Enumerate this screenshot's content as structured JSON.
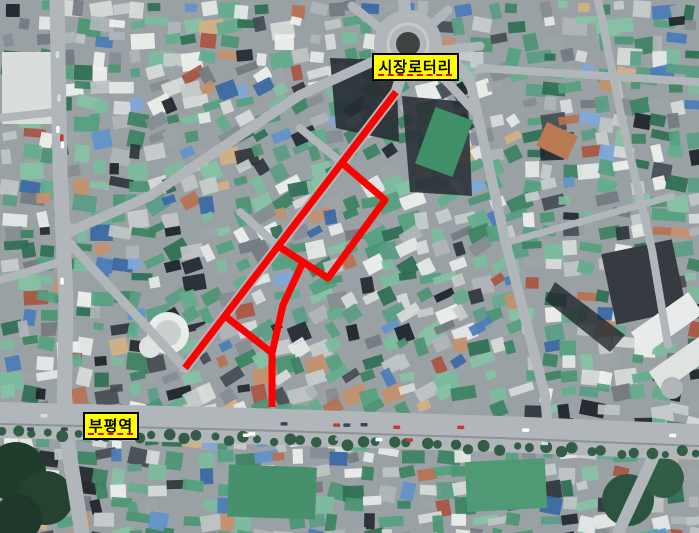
{
  "page": {
    "type": "aerial-map",
    "description": "부평역과 시장로터리 일대 항공사진 위에 붉은 선으로 표시한 시장 골목 구간"
  },
  "overlay": {
    "route_color": "#ff0000",
    "route_width": 7,
    "polylines": [
      [
        [
          396,
          92
        ],
        [
          185,
          368
        ]
      ],
      [
        [
          342,
          163
        ],
        [
          385,
          200
        ],
        [
          328,
          278
        ],
        [
          278,
          246
        ]
      ],
      [
        [
          303,
          262
        ],
        [
          283,
          305
        ],
        [
          272,
          353
        ],
        [
          272,
          407
        ]
      ],
      [
        [
          225,
          316
        ],
        [
          272,
          353
        ]
      ]
    ],
    "labels": [
      {
        "text": "시장로터리",
        "x": 372,
        "y": 53,
        "w": 87,
        "h": 28
      },
      {
        "text": "부평역",
        "x": 83,
        "y": 412,
        "w": 56,
        "h": 28
      }
    ],
    "label_style": {
      "bg": "#ffff00",
      "border": "#000000",
      "text": "#000000",
      "underline": "#ff0000"
    }
  },
  "map": {
    "width": 699,
    "height": 533,
    "palette": {
      "base": "#9aa1a5",
      "greens": [
        "#55a07f",
        "#4c9573",
        "#63ad8c",
        "#2f6e54",
        "#7cbc9e",
        "#3d8263",
        "#5b9c86",
        "#87c2a6"
      ],
      "lights": [
        "#e6e9e7",
        "#d8dcda",
        "#c8cdcc",
        "#f0f1ef",
        "#bfc5c4"
      ],
      "grays": [
        "#9da4a8",
        "#868d92",
        "#b0b5b8",
        "#747b80"
      ],
      "darks": [
        "#30363c",
        "#232830",
        "#454c52",
        "#1d2228"
      ],
      "blues": [
        "#6192cc",
        "#4a7cba",
        "#7fa8d8",
        "#3a68a4"
      ],
      "warms": [
        "#c4906b",
        "#b9714f",
        "#d3b184",
        "#a85540"
      ],
      "road": "#b0b6ba",
      "roadDark": "#8b9398",
      "tree": "#2c5940",
      "shadow": "#23282e",
      "carColors": [
        "#ffffff",
        "#d8dbe0",
        "#aab2ba",
        "#3c4450",
        "#c23b2e"
      ]
    },
    "rotary": {
      "cx": 408,
      "cy": 44,
      "r": 34,
      "ring_r": 20,
      "island_r": 12,
      "island_color": "#3e443f"
    },
    "roads": [
      {
        "pts": [
          [
            57,
            0
          ],
          [
            60,
            170
          ],
          [
            66,
            300
          ],
          [
            64,
            420
          ],
          [
            82,
            533
          ]
        ],
        "w": 15
      },
      {
        "pts": [
          [
            372,
            62
          ],
          [
            300,
            95
          ],
          [
            150,
            196
          ],
          [
            62,
            235
          ]
        ],
        "w": 10
      },
      {
        "pts": [
          [
            62,
            235
          ],
          [
            120,
            298
          ],
          [
            183,
            366
          ]
        ],
        "w": 9
      },
      {
        "pts": [
          [
            408,
            55
          ],
          [
            396,
            92
          ],
          [
            185,
            368
          ]
        ],
        "w": 11
      },
      {
        "pts": [
          [
            452,
            58
          ],
          [
            470,
            80
          ],
          [
            505,
            240
          ],
          [
            545,
            395
          ],
          [
            548,
            428
          ]
        ],
        "w": 10
      },
      {
        "pts": [
          [
            404,
            0
          ],
          [
            407,
            28
          ]
        ],
        "w": 12
      },
      {
        "pts": [
          [
            352,
            6
          ],
          [
            382,
            30
          ]
        ],
        "w": 9
      },
      {
        "pts": [
          [
            448,
            10
          ],
          [
            426,
            30
          ]
        ],
        "w": 9
      },
      {
        "pts": [
          [
            480,
            46
          ],
          [
            444,
            50
          ]
        ],
        "w": 9
      },
      {
        "pts": [
          [
            438,
            72
          ],
          [
            475,
            112
          ]
        ],
        "w": 9
      },
      {
        "pts": [
          [
            480,
            68
          ],
          [
            699,
            82
          ]
        ],
        "w": 8
      },
      {
        "pts": [
          [
            598,
            0
          ],
          [
            622,
            120
          ],
          [
            652,
            250
          ],
          [
            668,
            345
          ]
        ],
        "w": 8
      },
      {
        "pts": [
          [
            505,
            243
          ],
          [
            672,
            196
          ]
        ],
        "w": 7
      },
      {
        "pts": [
          [
            300,
            128
          ],
          [
            342,
            163
          ]
        ],
        "w": 8
      },
      {
        "pts": [
          [
            240,
            212
          ],
          [
            278,
            246
          ]
        ],
        "w": 8
      },
      {
        "pts": [
          [
            0,
            280
          ],
          [
            60,
            262
          ]
        ],
        "w": 8
      },
      {
        "pts": [
          [
            0,
            118
          ],
          [
            55,
            112
          ]
        ],
        "w": 8
      },
      {
        "pts": [
          [
            660,
            443
          ],
          [
            618,
            533
          ]
        ],
        "w": 12
      },
      {
        "pts": [
          [
            0,
            420
          ],
          [
            250,
            426
          ],
          [
            500,
            434
          ],
          [
            699,
            442
          ]
        ],
        "w": 36
      }
    ],
    "features": [
      {
        "t": "poly",
        "pts": [
          [
            330,
            58
          ],
          [
            396,
            60
          ],
          [
            399,
            142
          ],
          [
            336,
            128
          ]
        ],
        "f": "#262c32",
        "o": 0.9
      },
      {
        "t": "poly",
        "pts": [
          [
            402,
            96
          ],
          [
            468,
            102
          ],
          [
            472,
            196
          ],
          [
            410,
            192
          ]
        ],
        "f": "#2b3137",
        "o": 0.9
      },
      {
        "t": "poly",
        "pts": [
          [
            555,
            282
          ],
          [
            625,
            335
          ],
          [
            610,
            352
          ],
          [
            545,
            300
          ]
        ],
        "f": "#23282e",
        "o": 0.8
      },
      {
        "t": "rect",
        "x": 424,
        "y": 112,
        "w": 40,
        "h": 60,
        "r": 20,
        "f": "#3f8f68"
      },
      {
        "t": "rect",
        "x": 2,
        "y": 52,
        "w": 58,
        "h": 72,
        "r": 0,
        "f": "#d9dddb"
      },
      {
        "t": "rect",
        "x": 228,
        "y": 466,
        "w": 88,
        "h": 52,
        "r": 2,
        "f": "#47906c"
      },
      {
        "t": "rect",
        "x": 466,
        "y": 460,
        "w": 80,
        "h": 50,
        "r": -3,
        "f": "#4f9a74"
      },
      {
        "t": "rect",
        "x": 608,
        "y": 246,
        "w": 72,
        "h": 72,
        "r": -12,
        "f": "#353b41"
      },
      {
        "t": "rect",
        "x": 540,
        "y": 128,
        "w": 34,
        "h": 26,
        "r": 25,
        "f": "#b97a52"
      },
      {
        "t": "rect",
        "x": 632,
        "y": 310,
        "w": 70,
        "h": 26,
        "r": -35,
        "f": "#e8ebe9"
      },
      {
        "t": "rect",
        "x": 650,
        "y": 352,
        "w": 62,
        "h": 24,
        "r": -35,
        "f": "#dfe3e0"
      },
      {
        "t": "circle",
        "cx": 168,
        "cy": 333,
        "r": 21,
        "f": "#e9ece9"
      },
      {
        "t": "circle",
        "cx": 168,
        "cy": 333,
        "r": 13,
        "f": "#c9cfcd"
      },
      {
        "t": "circle",
        "cx": 150,
        "cy": 347,
        "r": 11,
        "f": "#dfe3e0"
      },
      {
        "t": "circle",
        "cx": 16,
        "cy": 472,
        "r": 30,
        "f": "#203c2b"
      },
      {
        "t": "circle",
        "cx": 46,
        "cy": 498,
        "r": 27,
        "f": "#24422f"
      },
      {
        "t": "circle",
        "cx": 18,
        "cy": 518,
        "r": 24,
        "f": "#1e3829"
      },
      {
        "t": "circle",
        "cx": 628,
        "cy": 500,
        "r": 26,
        "f": "#2c5440"
      },
      {
        "t": "circle",
        "cx": 664,
        "cy": 478,
        "r": 20,
        "f": "#315c46"
      },
      {
        "t": "circle",
        "cx": 672,
        "cy": 388,
        "r": 11,
        "f": "#b0b6ba"
      }
    ]
  }
}
